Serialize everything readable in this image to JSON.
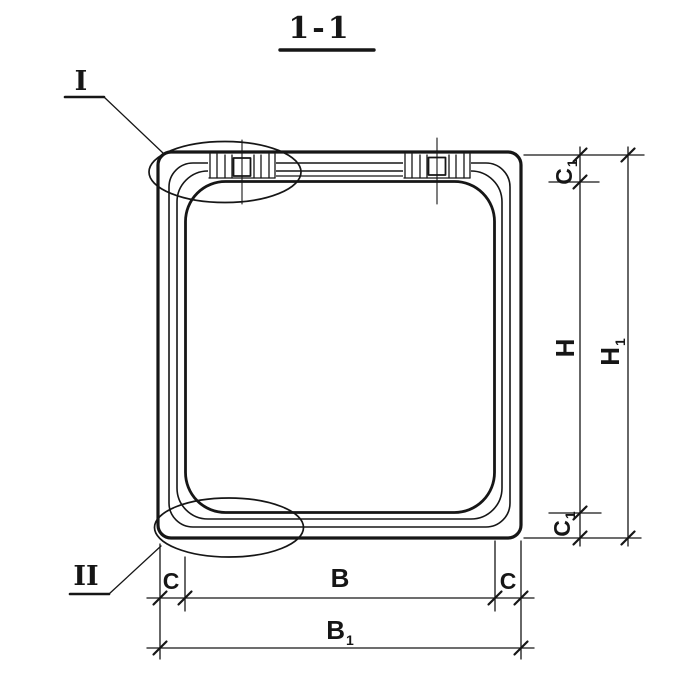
{
  "view": {
    "title": "1-1"
  },
  "detail_markers": {
    "first": "I",
    "second": "II"
  },
  "dims": {
    "inner_width": {
      "main": "B"
    },
    "outer_width": {
      "main": "B",
      "sub": "1"
    },
    "inner_height": {
      "main": "H"
    },
    "outer_height": {
      "main": "H",
      "sub": "1"
    },
    "wall_side_left": {
      "main": "C"
    },
    "wall_side_right": {
      "main": "C"
    },
    "wall_top": {
      "main": "C",
      "sub": "1"
    },
    "wall_bottom": {
      "main": "C",
      "sub": "1"
    }
  },
  "colors": {
    "ink": "#161616",
    "paper": "#ffffff"
  }
}
